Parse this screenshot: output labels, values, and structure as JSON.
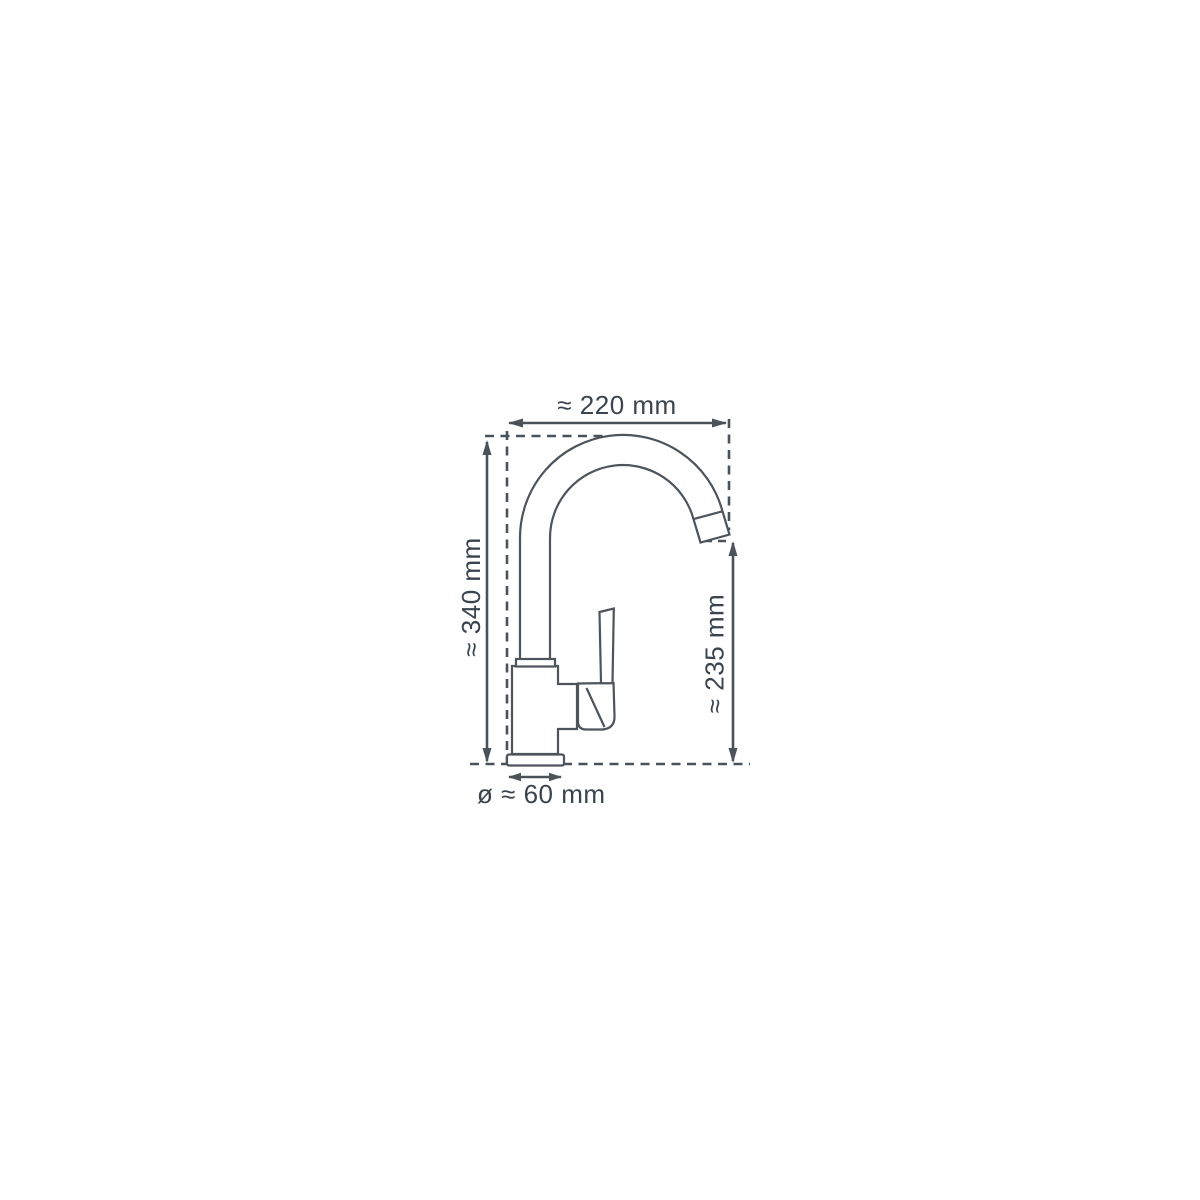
{
  "diagram": {
    "subject": "Kitchen mixer tap dimensional drawing, side view",
    "background_color": "#ffffff",
    "outline_color": "#4d545b",
    "dimension_color": "#4a525a",
    "text_color": "#3b444e",
    "dimensions": {
      "spout_width": {
        "label": "≈ 220 mm",
        "value_mm": 220
      },
      "total_height": {
        "label": "≈ 340 mm",
        "value_mm": 340
      },
      "outlet_height": {
        "label": "≈ 235 mm",
        "value_mm": 235
      },
      "base_diameter": {
        "label": "ø ≈ 60 mm",
        "value_mm": 60
      }
    }
  }
}
